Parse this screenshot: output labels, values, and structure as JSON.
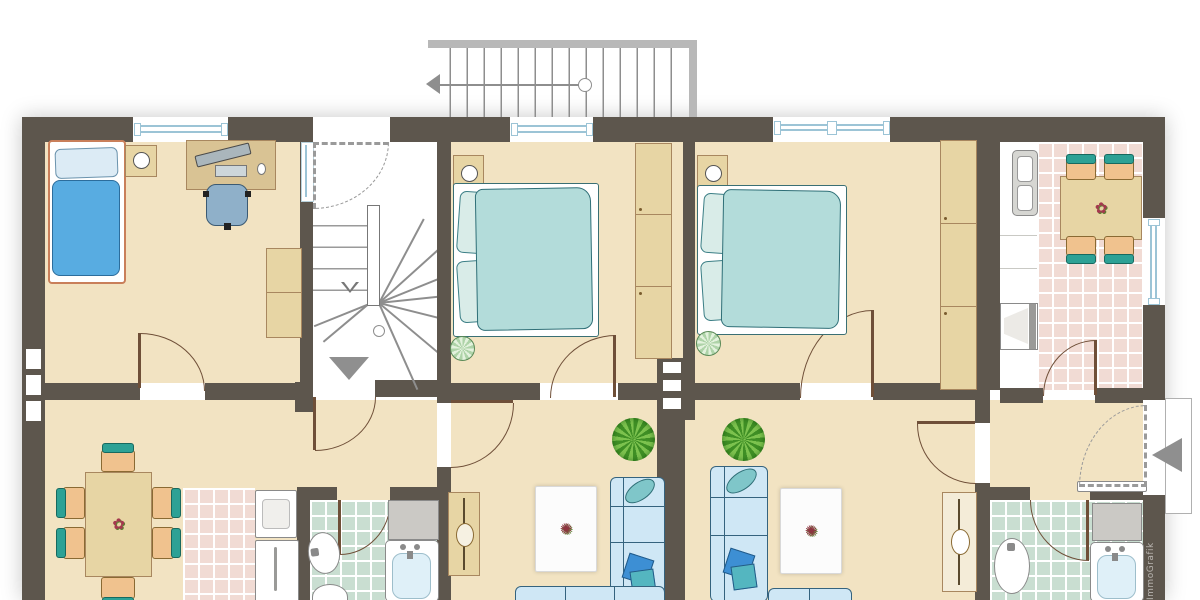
{
  "meta": {
    "type": "residential floor plan drawing"
  },
  "watermark": {
    "text": "ImmoGrafik"
  },
  "icons": {
    "entrance_arrow": "left-pointing solid triangle at entrance door",
    "stair_down_arrow": "down-pointing solid triangle in stairwell",
    "stair_direction_arrow": "small hollow down arrow on stair walk line",
    "exterior_stair_arrow": "left arrow with start circle on walk line"
  },
  "colors": {
    "wall": "#5d564d",
    "floor_beige": "#f2e3c2",
    "tile_pink": "#f1dbd4",
    "tile_green": "#c9ded1",
    "bed_double_teal": "#b3dcda",
    "bed_single_blue": "#58ace1",
    "sofa_blue": "#cfe7f5",
    "chair_back_teal": "#2da195",
    "chair_seat_orange": "#f0c28e",
    "furniture_wood": "#e7d5a4",
    "railing_gray": "#b8b8b8",
    "arrow_gray": "#8f8f8f",
    "door_swing_brown": "#6f4f38",
    "window_glazing_blue": "#9cc4d6",
    "plant_green": "#4e9b2e",
    "rug_white": "#fcfcfc",
    "flower_red": "#a4394e",
    "fixture_gray": "#8a8a8a"
  }
}
